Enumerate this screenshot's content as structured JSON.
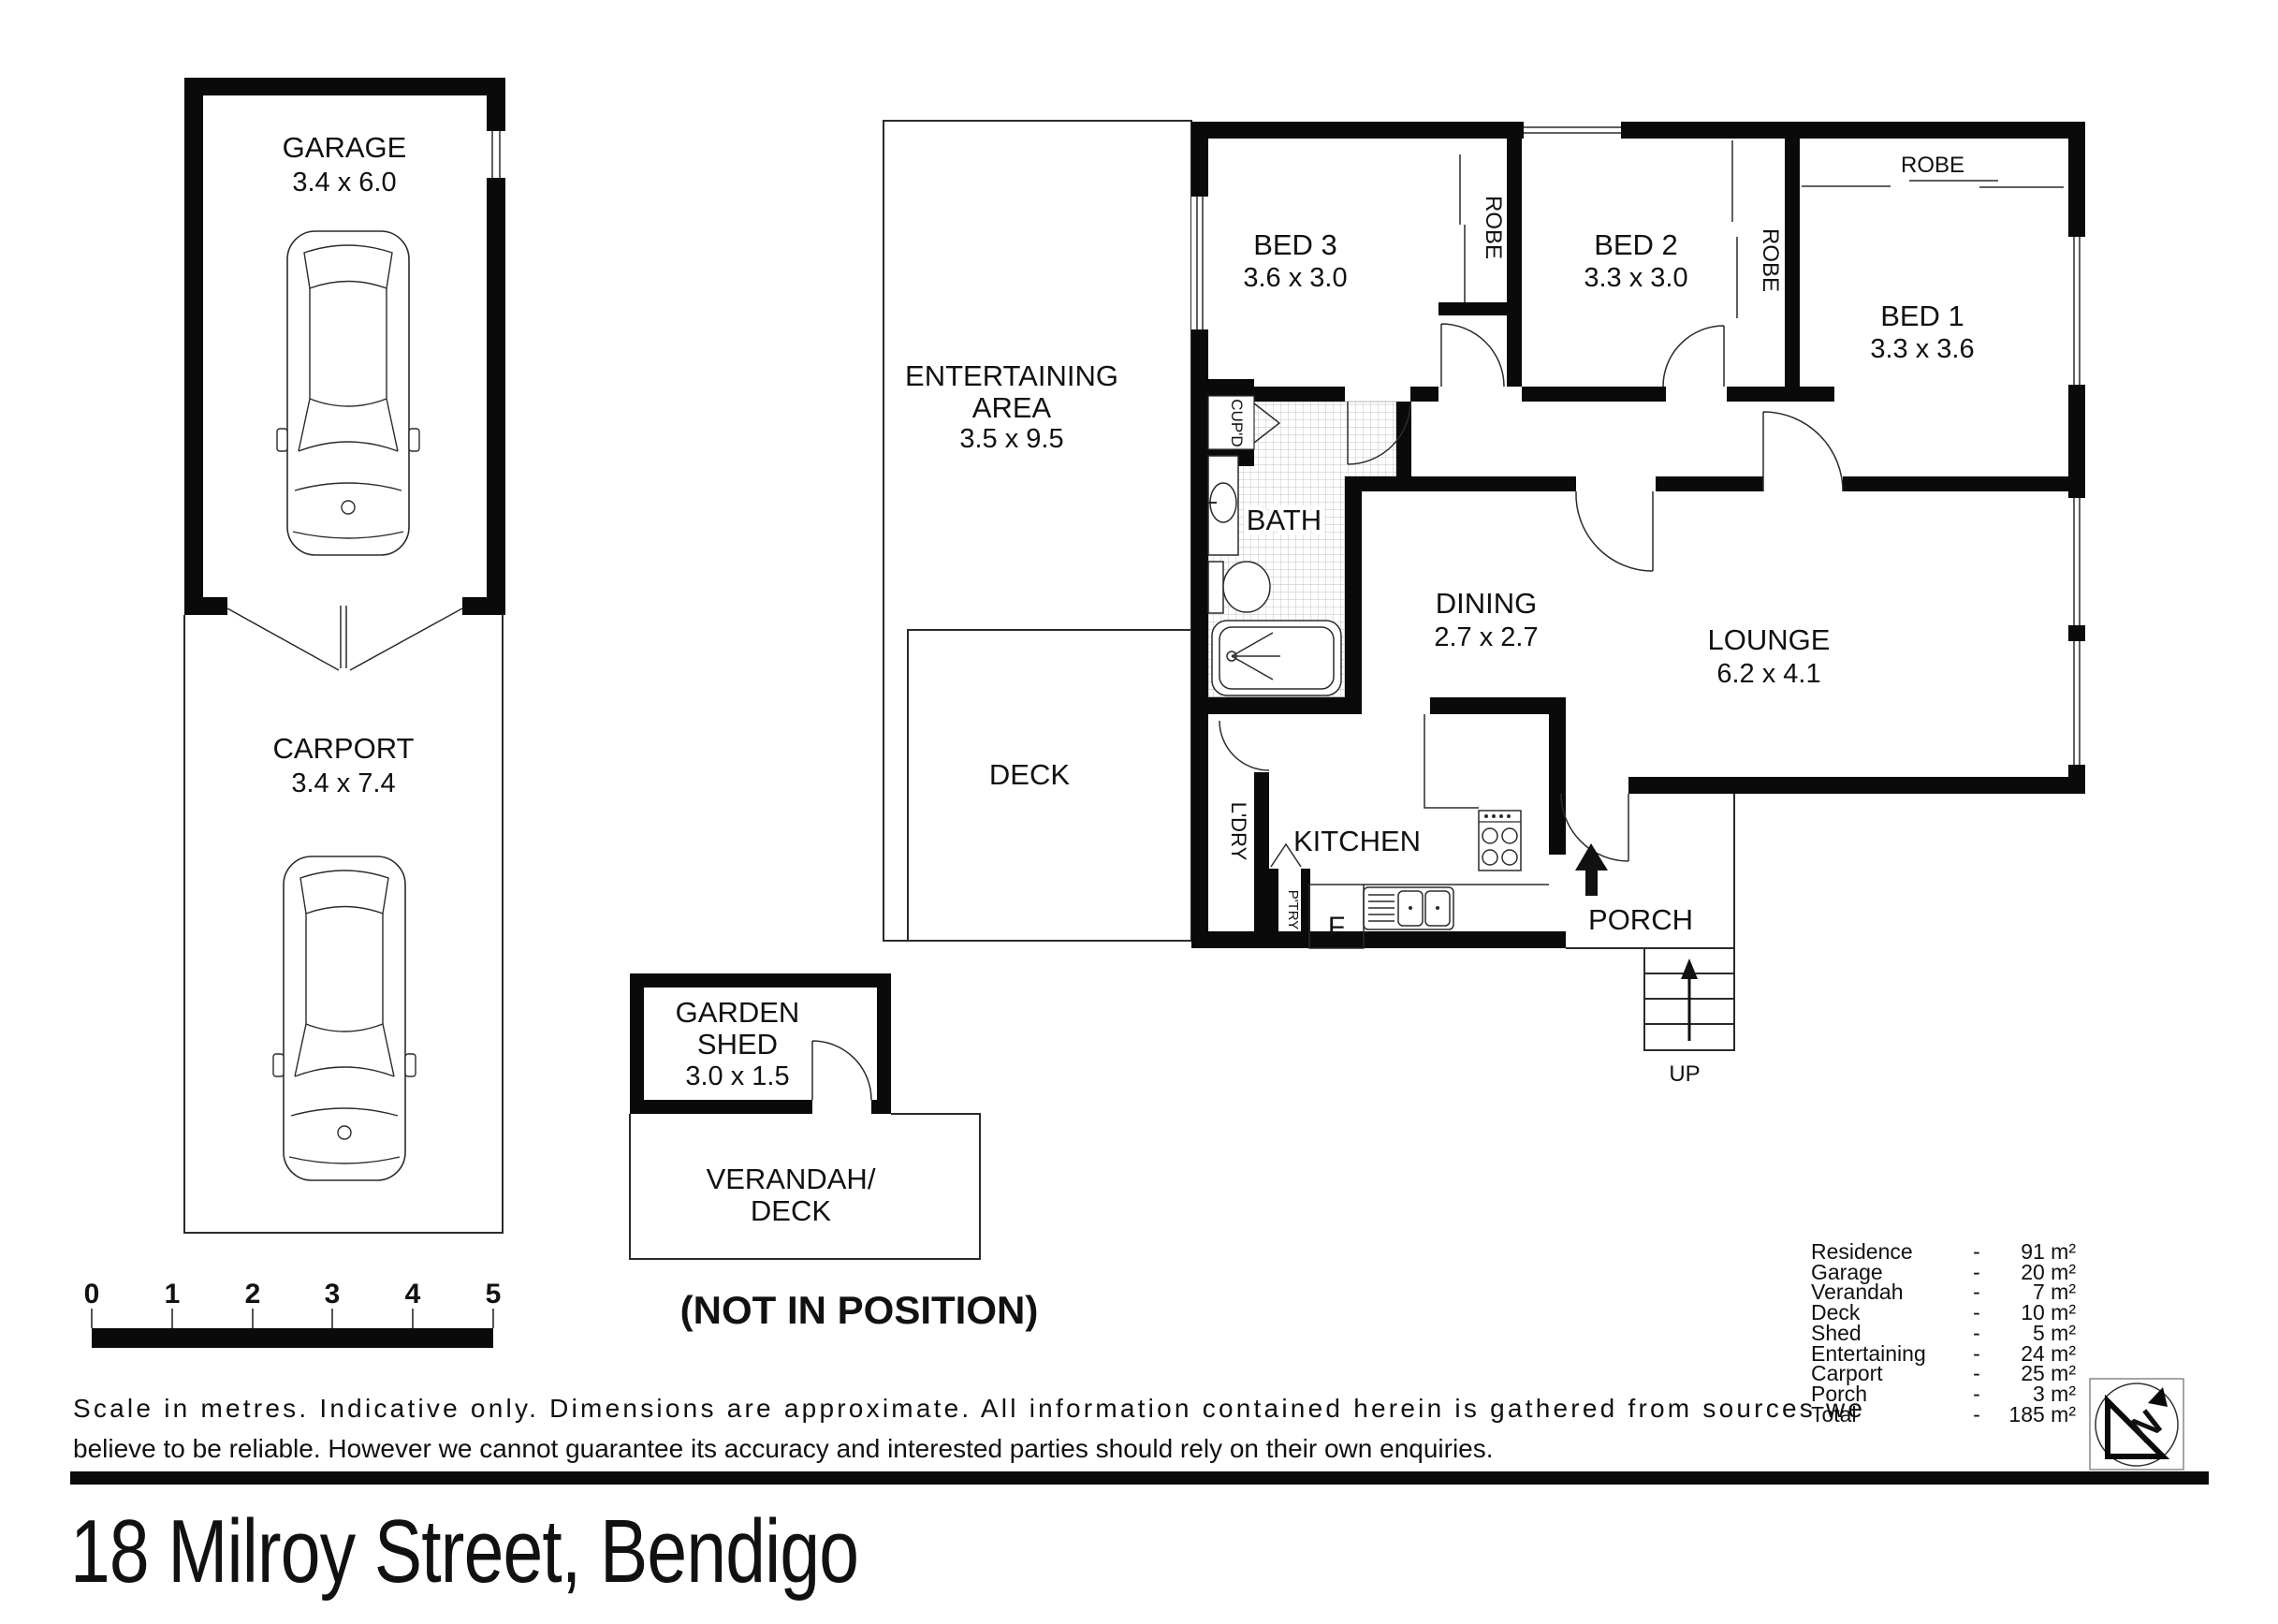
{
  "title": {
    "text": "18 Milroy Street, Bendigo"
  },
  "outbuildings": {
    "garage": {
      "label": "GARAGE",
      "dims": "3.4 x 6.0"
    },
    "carport": {
      "label": "CARPORT",
      "dims": "3.4 x 7.4"
    },
    "shed": {
      "label_line1": "GARDEN",
      "label_line2": "SHED",
      "dims": "3.0 x 1.5"
    },
    "verandah": {
      "label_line1": "VERANDAH/",
      "label_line2": "DECK"
    },
    "position_note": "(NOT IN POSITION)"
  },
  "rooms": {
    "entertaining": {
      "label_line1": "ENTERTAINING",
      "label_line2": "AREA",
      "dims": "3.5 x 9.5"
    },
    "deck": {
      "label": "DECK"
    },
    "bed3": {
      "label": "BED 3",
      "dims": "3.6 x 3.0"
    },
    "bed2": {
      "label": "BED 2",
      "dims": "3.3 x 3.0"
    },
    "bed1": {
      "label": "BED 1",
      "dims": "3.3 x 3.6"
    },
    "robe_bed3": {
      "label": "ROBE"
    },
    "robe_bed2": {
      "label": "ROBE"
    },
    "robe_bed1": {
      "label": "ROBE"
    },
    "cupboard": {
      "label": "CUP'D"
    },
    "bath": {
      "label": "BATH"
    },
    "dining": {
      "label": "DINING",
      "dims": "2.7 x 2.7"
    },
    "lounge": {
      "label": "LOUNGE",
      "dims": "6.2 x 4.1"
    },
    "laundry": {
      "label": "L'DRY"
    },
    "pantry": {
      "label": "P'TRY"
    },
    "fridge": {
      "label": "F"
    },
    "kitchen": {
      "label": "KITCHEN"
    },
    "porch": {
      "label": "PORCH"
    },
    "stairs": {
      "label": "UP"
    }
  },
  "scale_bar": {
    "ticks": [
      "0",
      "1",
      "2",
      "3",
      "4",
      "5"
    ]
  },
  "disclaimer": {
    "line1": "Scale in metres. Indicative only. Dimensions are approximate.  All information contained herein is gathered from sources we",
    "line2": "believe to be reliable. However we cannot guarantee its accuracy and interested parties should rely on their own enquiries."
  },
  "areas": {
    "rows": [
      {
        "label": "Residence",
        "sep": "-",
        "value": "91 m²"
      },
      {
        "label": "Garage",
        "sep": "-",
        "value": "20 m²"
      },
      {
        "label": "Verandah",
        "sep": "-",
        "value": "7 m²"
      },
      {
        "label": "Deck",
        "sep": "-",
        "value": "10 m²"
      },
      {
        "label": "Shed",
        "sep": "-",
        "value": "5 m²"
      },
      {
        "label": "Entertaining",
        "sep": "-",
        "value": "24 m²"
      },
      {
        "label": "Carport",
        "sep": "-",
        "value": "25 m²"
      },
      {
        "label": "Porch",
        "sep": "-",
        "value": "3 m²"
      },
      {
        "label": "Total",
        "sep": "-",
        "value": "185 m²"
      }
    ]
  },
  "compass": {
    "label": "N"
  }
}
